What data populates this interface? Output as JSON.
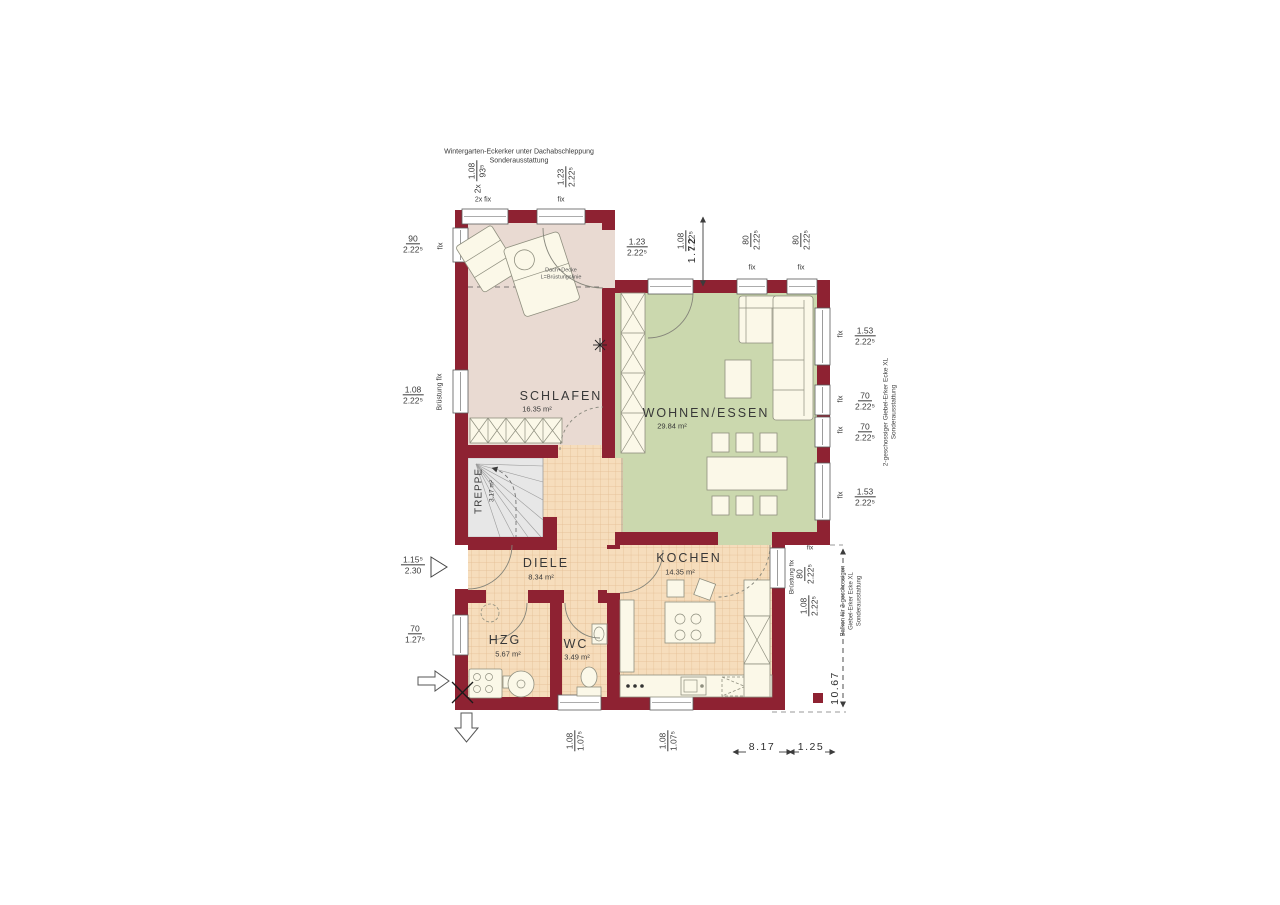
{
  "colors": {
    "wall": "#8e2232",
    "floor_schlafen": "#e9dad2",
    "floor_wohnen": "#cbd8ae",
    "floor_tile": "#f6ddbc",
    "tile_line": "#e2bb90",
    "floor_stairs": "#e7e7e7"
  },
  "notes": {
    "top": [
      "Wintergarten-Eckerker unter Dachabschleppung",
      "Sonderausstattung"
    ],
    "erker_right": [
      "2-geschossiger Giebel-Erker Ecke XL",
      "Sonderausstattung"
    ],
    "balkon_right": [
      "Balkon für 2-geschossigen",
      "Giebel-Erker Ecke XL",
      "Sonderausstattung"
    ],
    "bedroom": [
      "Dach+Decke",
      "L=Brüstungslinie"
    ]
  },
  "rooms": {
    "schlafen": {
      "name": "SCHLAFEN",
      "area": "16.35 m²"
    },
    "wohnen_essen": {
      "name": "WOHNEN/ESSEN",
      "area": "29.84 m²"
    },
    "kochen": {
      "name": "KOCHEN",
      "area": "14.35 m²"
    },
    "diele": {
      "name": "DIELE",
      "area": "8.34 m²"
    },
    "hzg": {
      "name": "HZG",
      "area": "5.67 m²"
    },
    "wc": {
      "name": "WC",
      "area": "3.49 m²"
    },
    "treppe": {
      "name": "TREPPE",
      "area": "3.17 m²"
    }
  },
  "labels": {
    "fix": "fix",
    "fix_2x": "2x fix",
    "bruestung_fix": "Brüstung fix"
  },
  "dims": {
    "top_a": {
      "pre": "2x",
      "n": "1.08",
      "d": "93⁵"
    },
    "top_b": {
      "n": "1.23",
      "d": "2.22⁵"
    },
    "top_c": {
      "n": "1.23",
      "d": "2.22⁵"
    },
    "top_d": {
      "n": "1.08",
      "d": "2.22⁵"
    },
    "erker_depth": "1.72",
    "top_f": {
      "n": "80",
      "d": "2.22⁵"
    },
    "top_g": {
      "n": "80",
      "d": "2.22⁵"
    },
    "left_a": {
      "n": "90",
      "d": "2.22⁵"
    },
    "left_b": {
      "n": "1.08",
      "d": "2.22⁵"
    },
    "left_door": {
      "n": "1.15⁵",
      "d": "2.30"
    },
    "left_d": {
      "n": "70",
      "d": "1.27⁵"
    },
    "right_a": {
      "n": "1.53",
      "d": "2.22⁵"
    },
    "right_b": {
      "n": "70",
      "d": "2.22⁵"
    },
    "right_c": {
      "n": "70",
      "d": "2.22⁵"
    },
    "right_d": {
      "n": "1.53",
      "d": "2.22⁵"
    },
    "right_e": {
      "n": "80",
      "d": "2.22⁵"
    },
    "right_f": {
      "n": "1.08",
      "d": "2.22⁵"
    },
    "bottom_a": {
      "n": "1.08",
      "d": "1.07⁵"
    },
    "bottom_b": {
      "n": "1.08",
      "d": "1.07⁵"
    },
    "total_width": "8.17",
    "balkon_width": "1.25",
    "total_depth": "10.67"
  }
}
